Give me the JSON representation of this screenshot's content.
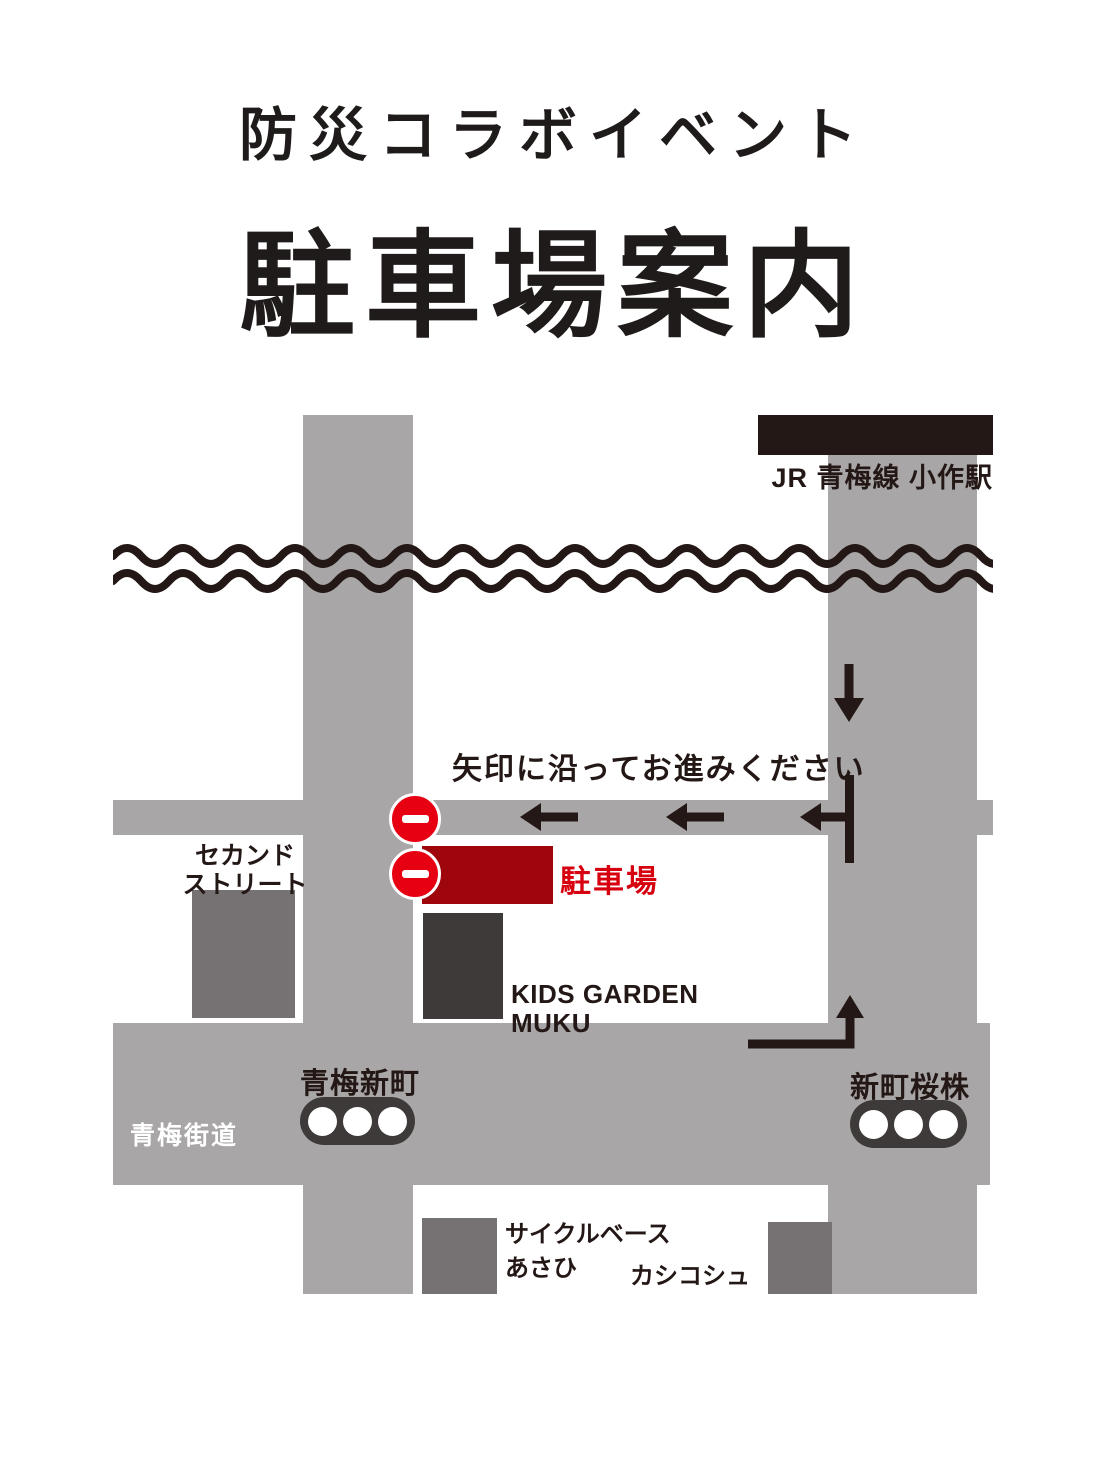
{
  "title": {
    "event_line": "防災コラボイベント",
    "main_line": "駐車場案内"
  },
  "map": {
    "station": {
      "label": "JR 青梅線 小作駅"
    },
    "instruction": "矢印に沿ってお進みください",
    "parking": {
      "label": "駐車場"
    },
    "roads": {
      "oume_kaido_label": "青梅街道"
    },
    "intersections": {
      "oume_shinmachi": "青梅新町",
      "shinmachi_sakurakabu": "新町桜株"
    },
    "buildings": {
      "second_street": {
        "line1": "セカンド",
        "line2": "ストリート"
      },
      "kids_garden": {
        "line1": "KIDS GARDEN",
        "line2": "MUKU"
      },
      "cycle_base": {
        "line1": "サイクルベース",
        "line2": "あさひ"
      },
      "kashikoshu": {
        "label": "カシコシュ"
      }
    },
    "icons": {
      "no_entry_sign": "red circle with white horizontal bar (x2)",
      "down_arrow": "↓",
      "left_arrow": "← (x3)",
      "up_turn_arrow": "right-angle turn arrow pointing up",
      "traffic_light": "dark rounded rectangle with 3 white lamps (x2)",
      "river": "double wavy line",
      "station": "black bar"
    },
    "colors": {
      "road_gray": "#A9A6A7",
      "building_gray": "#767173",
      "building_dark": "#3E3A39",
      "ink": "#231815",
      "parking_fill": "#9E060C",
      "parking_text": "#D7000F",
      "sign_red": "#E60012",
      "background": "#FFFFFF"
    }
  }
}
